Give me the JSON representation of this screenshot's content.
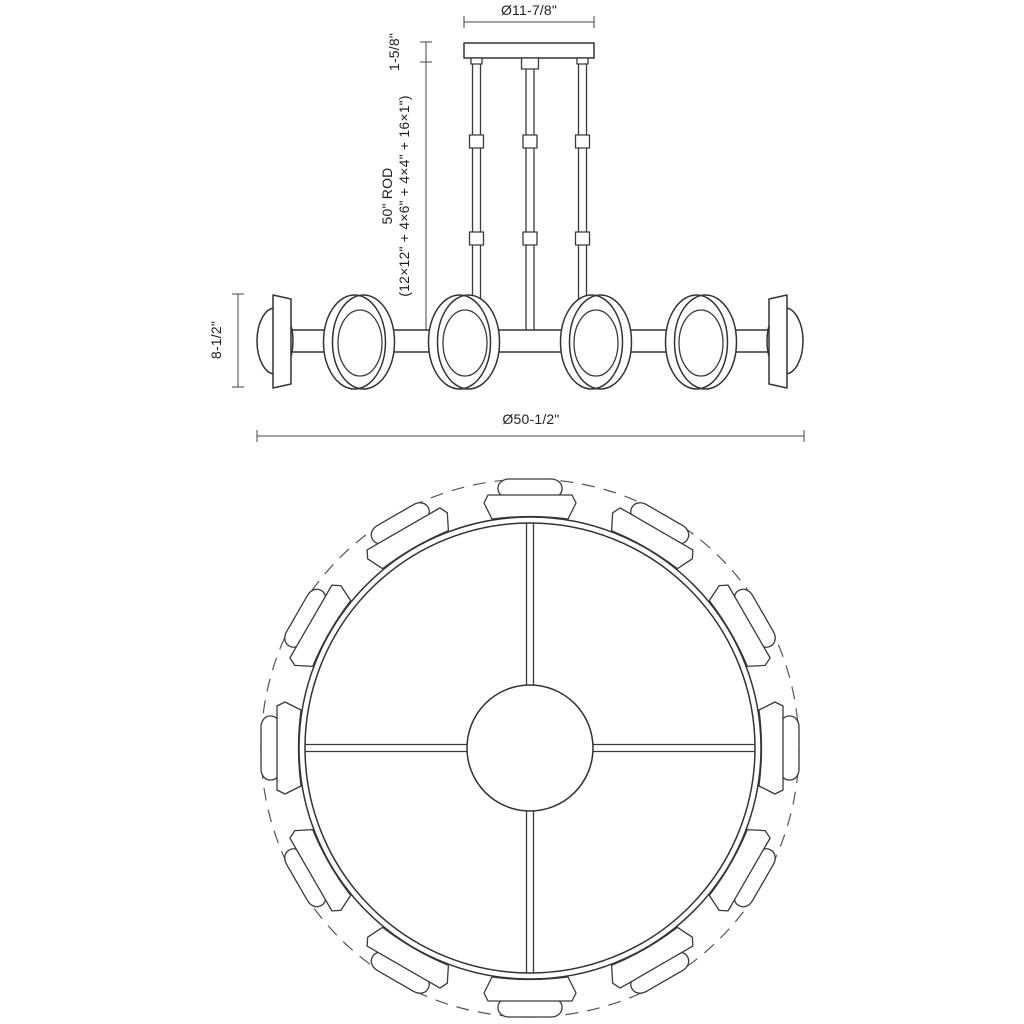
{
  "document": {
    "title": "Chandelier specification line drawing",
    "background": "#ffffff",
    "line_color": "#333333",
    "dim_line_color": "#444444",
    "text_color": "#1f1f1f"
  },
  "dimensions": {
    "canopy_diameter": "Ø11-7/8\"",
    "canopy_height": "1-5/8\"",
    "rod_length": "50\" ROD",
    "rod_breakdown": "(12×12\" + 4×6\" + 4×4\" + 16×1\")",
    "fixture_height": "8-1/2\"",
    "fixture_diameter": "Ø50-1/2\""
  },
  "views": {
    "side_elevation": {
      "rods": 3,
      "couplers_per_rod": 2,
      "ring_lights_visible": 4,
      "end_domes_visible": 2
    },
    "top_plan": {
      "light_pods": 12,
      "spokes": 4,
      "center_hub": 1
    }
  }
}
